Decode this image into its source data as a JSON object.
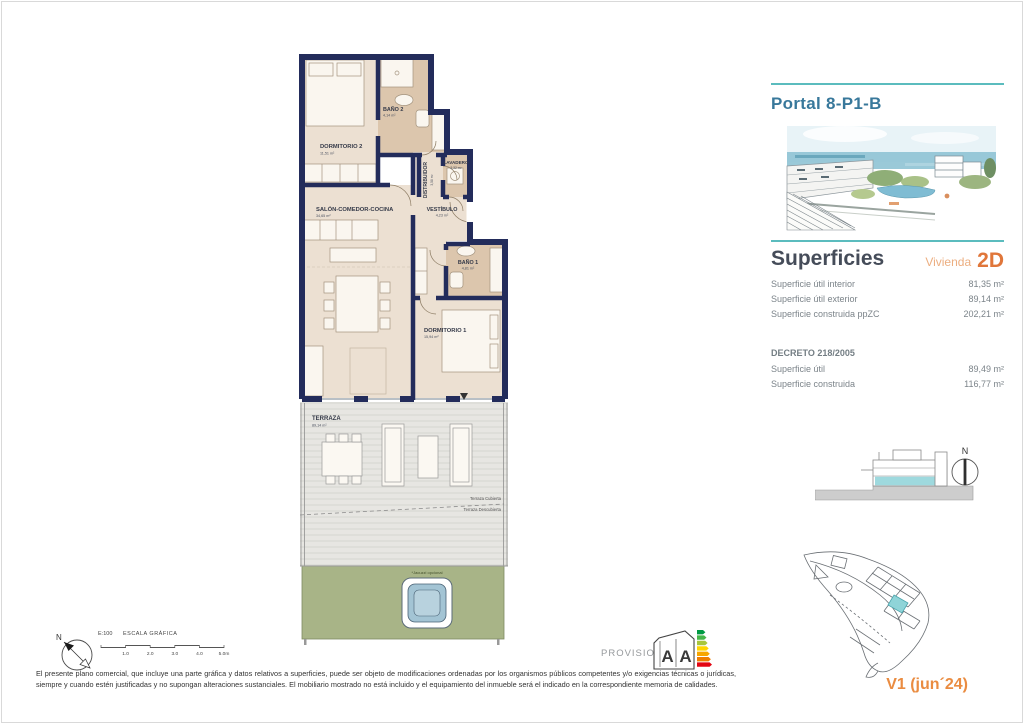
{
  "document": {
    "portal_title": "Portal 8-P1-B",
    "version": "V1 (jun´24)",
    "disclaimer": "El presente plano comercial, que incluye una parte gráfica y datos relativos a superficies, puede ser objeto de modificaciones ordenadas por los organismos públicos competentes y/o exigencias técnicas o jurídicas, siempre y cuando estén justificadas y no supongan alteraciones sustanciales. El mobiliario mostrado no está incluido y el equipamiento del inmueble será el indicado en la correspondiente memoria de calidades."
  },
  "superficies": {
    "title": "Superficies",
    "vivienda_label": "Vivienda",
    "vivienda_code": "2D",
    "rows": [
      {
        "label": "Superficie útil interior",
        "value": "81,35 m²"
      },
      {
        "label": "Superficie útil exterior",
        "value": "89,14 m²"
      },
      {
        "label": "Superficie construida ppZC",
        "value": "202,21 m²"
      }
    ]
  },
  "decreto": {
    "title": "DECRETO 218/2005",
    "rows": [
      {
        "label": "Superficie útil",
        "value": "89,49 m²"
      },
      {
        "label": "Superficie construida",
        "value": "116,77 m²"
      }
    ]
  },
  "plan": {
    "rooms": [
      {
        "name": "DORMITORIO 2",
        "area": "11,51 m²"
      },
      {
        "name": "BAÑO 2",
        "area": "4,14 m²"
      },
      {
        "name": "DISTRIBUIDOR",
        "area": "3,58 m²"
      },
      {
        "name": "LAVADERO",
        "area": "2,32 m²"
      },
      {
        "name": "SALÓN-COMEDOR-COCINA",
        "area": "34,65 m²"
      },
      {
        "name": "VESTÍBULO",
        "area": "4,23 m²"
      },
      {
        "name": "BAÑO 1",
        "area": "4,81 m²"
      },
      {
        "name": "DORMITORIO 1",
        "area": "15,94 m²"
      },
      {
        "name": "TERRAZA",
        "area": "89,14 m²"
      }
    ],
    "annotations": {
      "terraza_cubierta": "Terraza Cubierta",
      "terraza_descubierta": "Terraza Descubierta",
      "jacuzzi_note": "*Jacuzzi opcional"
    }
  },
  "scale_bar": {
    "scale": "E:100",
    "label": "ESCALA GRÁFICA",
    "ticks": [
      "1.0",
      "2.0",
      "3.0",
      "4.0",
      "5.0m"
    ]
  },
  "energy": {
    "provisional": "PROVISIONAL",
    "letters": [
      "A",
      "A"
    ],
    "arrow_colors": [
      "#009a44",
      "#45b649",
      "#a8c63c",
      "#ffd500",
      "#f7a600",
      "#ef7d00",
      "#e30613"
    ]
  },
  "compass": {
    "north_label": "N"
  },
  "colors": {
    "wall_navy": "#232c5b",
    "accent_teal": "#5bbcbe",
    "portal_blue": "#38789b",
    "orange": "#e0763a",
    "light_orange": "#ecae80",
    "garden_green": "#a8b487",
    "highlight_teal": "#9ed9de"
  }
}
